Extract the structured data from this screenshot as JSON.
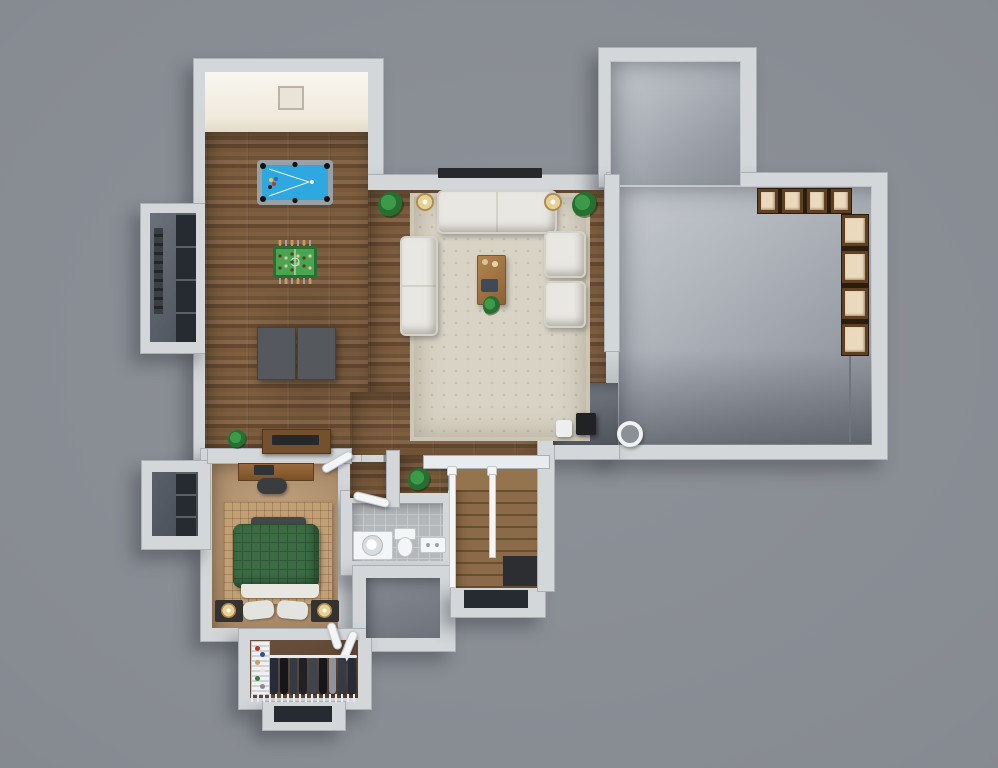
{
  "scene": {
    "type": "3d-floor-plan-rendering",
    "view": "top-down",
    "level": "walk-out basement",
    "canvas": {
      "width": 998,
      "height": 768
    }
  },
  "palette": {
    "bg": "#8d9198",
    "wall": "#d3d7da",
    "wall_edge": "#aab0b5",
    "beam": "#e9ecee",
    "door": "#f2f3f4",
    "cream_a": "#f8f6f0",
    "cream_b": "#efe9da",
    "frame_line": "#b9b4a6",
    "wa": "#7d5e3f",
    "wb": "#6f5337",
    "wc": "#87664a",
    "wd": "#64492f",
    "we": "#7a5a3c",
    "rug": "#d9d3c5",
    "rug_border": "#cdc6b4",
    "rug_dot": "#c5beac",
    "sofa": "#e9e7e2",
    "sofa_line": "#d4d1c9",
    "lamp_core": "#e8d094",
    "lamp_ring": "#a98d52",
    "plant_a": "#3d9a49",
    "plant_b": "#256f31",
    "pool_frame": "#9aa1a6",
    "pool_felt": "#2fa7e0",
    "foos_frame": "#2a6e33",
    "foos_field": "#4aa551",
    "foos_rod": "#c6cbd0",
    "foos_handle": "#c79b62",
    "foos_team_a": "#5b3b22",
    "foos_team_b": "#e0c9a0",
    "tbl_dark": "#55595e",
    "tbl_dark_edge": "#3f4246",
    "console": "#74502c",
    "tv": "#26282b",
    "carpet_a": "#c3a483",
    "carpet_b": "#a2825f",
    "bed_rug": "#c2a075",
    "bench": "#43474c",
    "duvet": "#3c6b44",
    "duvet_line": "#2f5636",
    "sheet": "#e9e7e2",
    "pillow": "#e3e4df",
    "nightstand": "#34322f",
    "tile_a": "#b4b8ba",
    "tile_line": "#c8cbcd",
    "fixture": "#f4f5f6",
    "fixture_edge": "#c3c8ca",
    "con_a": "#c7cbd0",
    "con_b": "#aeb3ba",
    "con_c": "#989da5",
    "con_d": "#898e96",
    "strip_a": "#868b93",
    "strip_b": "#6d727b",
    "stair_a": "#8a6a48",
    "stair_b": "#68502f",
    "void": "#2c2e31",
    "well_a": "#6a717a",
    "well_b": "#59606a",
    "well_win": "#262b31",
    "closet_floor": "#5f4836",
    "wire": "#e8eaec",
    "conduit": "#70767e",
    "shelf_wood": "#5f4023",
    "shelf_box": "#ead9bd",
    "shelf_gap": "#2a1d0e",
    "obj_white": "#eceef0",
    "obj_black": "#202225",
    "drain_hole": "#8b9097",
    "g1": "#262b38",
    "g2": "#14161b",
    "g3": "#343a46",
    "g4": "#1e2128",
    "g5": "#3e4450",
    "g6": "#8d929c",
    "s1": "#b23b2e",
    "s2": "#2e4f90",
    "s3": "#c99e63",
    "s4": "#e6e6e6",
    "s5": "#3f7c3d",
    "s6": "#8a8a8a"
  },
  "rooms": [
    {
      "id": "game-room",
      "floor": "hardwood",
      "position": "upper-left"
    },
    {
      "id": "lookout-alcove",
      "floor": "daylight-concrete",
      "position": "top-of-game-room"
    },
    {
      "id": "living-area",
      "floor": "hardwood",
      "position": "upper-middle"
    },
    {
      "id": "unfinished-storage",
      "floor": "concrete",
      "position": "right"
    },
    {
      "id": "hallway",
      "floor": "hardwood",
      "position": "center"
    },
    {
      "id": "staircase",
      "floor": "hardwood-treads",
      "position": "center-bottom"
    },
    {
      "id": "bedroom",
      "floor": "carpet",
      "position": "lower-left"
    },
    {
      "id": "bathroom",
      "floor": "tile",
      "position": "center-bottom"
    },
    {
      "id": "mechanical-room",
      "floor": "concrete",
      "position": "below-bathroom"
    },
    {
      "id": "walk-in-closet",
      "floor": "hardwood",
      "position": "bottom"
    },
    {
      "id": "window-well-upper",
      "position": "left"
    },
    {
      "id": "window-well-lower",
      "position": "left"
    },
    {
      "id": "stair-window-well",
      "position": "below-stairs"
    },
    {
      "id": "closet-window-well",
      "position": "bottom"
    }
  ],
  "furniture": [
    {
      "id": "pool-table",
      "room": "game-room"
    },
    {
      "id": "foosball-table",
      "room": "game-room"
    },
    {
      "id": "folded-game-table",
      "room": "game-room"
    },
    {
      "id": "media-console-tv",
      "room": "game-room"
    },
    {
      "id": "wall-tv",
      "room": "living-area"
    },
    {
      "id": "area-rug",
      "room": "living-area"
    },
    {
      "id": "sofa-top",
      "room": "living-area"
    },
    {
      "id": "sofa-left",
      "room": "living-area"
    },
    {
      "id": "armchair-1",
      "room": "living-area"
    },
    {
      "id": "armchair-2",
      "room": "living-area"
    },
    {
      "id": "coffee-table",
      "room": "living-area"
    },
    {
      "id": "floor-lamp-1",
      "room": "living-area"
    },
    {
      "id": "floor-lamp-2",
      "room": "living-area"
    },
    {
      "id": "potted-plants",
      "count": 5
    },
    {
      "id": "storage-shelves-top",
      "room": "unfinished-storage"
    },
    {
      "id": "storage-shelves-right",
      "room": "unfinished-storage"
    },
    {
      "id": "white-bin",
      "room": "unfinished-storage"
    },
    {
      "id": "black-bin",
      "room": "unfinished-storage"
    },
    {
      "id": "floor-drain",
      "room": "unfinished-storage"
    },
    {
      "id": "desk-with-chair",
      "room": "bedroom"
    },
    {
      "id": "bed-green",
      "room": "bedroom"
    },
    {
      "id": "foot-bench",
      "room": "bedroom"
    },
    {
      "id": "nightstand-left",
      "room": "bedroom"
    },
    {
      "id": "nightstand-right",
      "room": "bedroom"
    },
    {
      "id": "vanity-sink",
      "room": "bathroom"
    },
    {
      "id": "toilet",
      "room": "bathroom"
    },
    {
      "id": "wall-register",
      "room": "bathroom"
    },
    {
      "id": "shoe-rack",
      "room": "walk-in-closet"
    },
    {
      "id": "hanging-clothes",
      "room": "walk-in-closet"
    },
    {
      "id": "wire-shelf",
      "room": "walk-in-closet"
    }
  ]
}
